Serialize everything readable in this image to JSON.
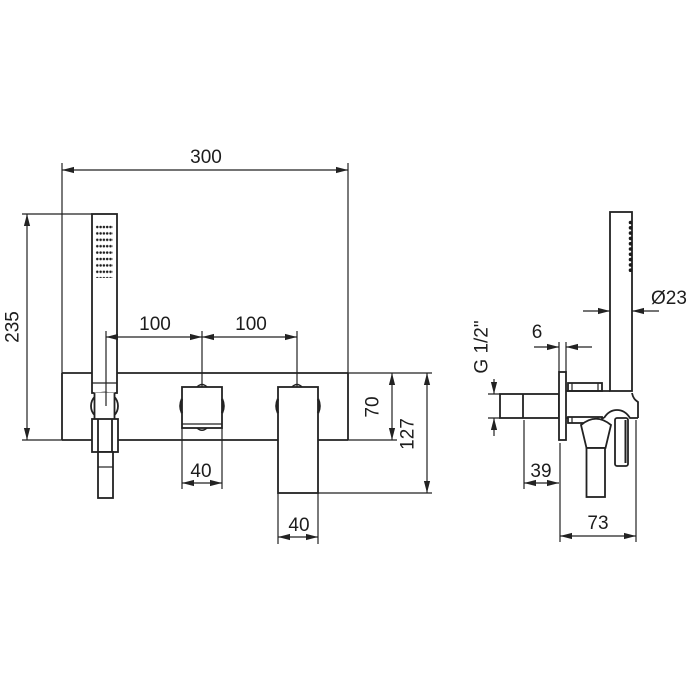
{
  "meta": {
    "type": "technical dimension drawing - wall mounted bath shower mixer with handshower",
    "background_color": "#ffffff",
    "line_color": "#222222"
  },
  "front": {
    "overall_width": "300",
    "shower_height": "235",
    "spacing_1": "100",
    "spacing_2": "100",
    "handle_width": "40",
    "lever_width": "40",
    "plate_height": "70",
    "lever_drop": "127"
  },
  "side": {
    "shower_diameter": "Ø23",
    "plate_thickness": "6",
    "connection_thread": "G 1/2\"",
    "recess_depth": "39",
    "projection": "73"
  }
}
